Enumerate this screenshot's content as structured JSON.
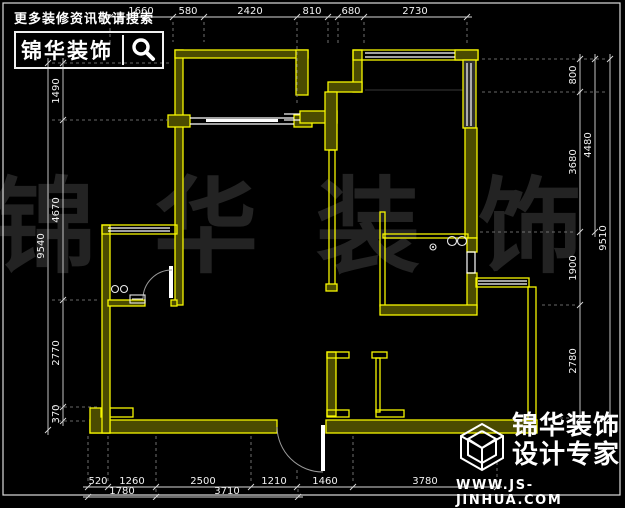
{
  "header": {
    "promo_text": "更多装修资讯敬请搜索",
    "brand": "锦华装饰"
  },
  "watermark": {
    "text": "锦华装饰"
  },
  "logo": {
    "brand": "锦华装饰",
    "tagline": "设计专家",
    "website": "WWW.JS-JINHUA.COM"
  },
  "colors": {
    "background": "#000000",
    "wall": "#f7f700",
    "wall_fill": "#4b4b00",
    "window": "#ffffff",
    "dimension_text": "#f2f2f2",
    "watermark": "#232323"
  },
  "dimension_chains": [
    {
      "id": "top-1",
      "orient": "h",
      "pos": 17,
      "ticks": [
        110,
        173,
        204,
        297,
        328
      ],
      "labels": [
        {
          "value": "1660",
          "at": 141
        },
        {
          "value": "580",
          "at": 188
        },
        {
          "value": "2420",
          "at": 250
        },
        {
          "value": "810",
          "at": 312
        }
      ]
    },
    {
      "id": "top-2",
      "orient": "h",
      "pos": 17,
      "ticks": [
        338,
        364,
        467
      ],
      "labels": [
        {
          "value": "680",
          "at": 351
        },
        {
          "value": "2730",
          "at": 415
        }
      ]
    },
    {
      "id": "left-outer",
      "orient": "v",
      "pos": 48,
      "ticks": [
        63,
        430
      ],
      "labels": [
        {
          "value": "9540",
          "at": 246
        }
      ]
    },
    {
      "id": "left-inner",
      "orient": "v",
      "pos": 63,
      "ticks": [
        63,
        120,
        300,
        407,
        421
      ],
      "labels": [
        {
          "value": "1490",
          "at": 91
        },
        {
          "value": "4670",
          "at": 210
        },
        {
          "value": "2770",
          "at": 353
        },
        {
          "value": "370",
          "at": 414
        }
      ]
    },
    {
      "id": "right-inner",
      "orient": "v",
      "pos": 580,
      "ticks": [
        59,
        92,
        232,
        305,
        418
      ],
      "labels": [
        {
          "value": "800",
          "at": 75
        },
        {
          "value": "3680",
          "at": 162
        },
        {
          "value": "1900",
          "at": 268
        },
        {
          "value": "2780",
          "at": 361
        }
      ]
    },
    {
      "id": "right-middle",
      "orient": "v",
      "pos": 595,
      "ticks": [
        59,
        232
      ],
      "labels": [
        {
          "value": "4480",
          "at": 145
        }
      ]
    },
    {
      "id": "right-outer",
      "orient": "v",
      "pos": 610,
      "ticks": [
        59,
        418
      ],
      "labels": [
        {
          "value": "9510",
          "at": 238
        }
      ]
    },
    {
      "id": "bottom-1",
      "orient": "h",
      "pos": 487,
      "ticks": [
        88,
        108,
        156,
        251,
        297,
        353,
        497
      ],
      "labels": [
        {
          "value": "520",
          "at": 98
        },
        {
          "value": "1260",
          "at": 132
        },
        {
          "value": "2500",
          "at": 203
        },
        {
          "value": "1210",
          "at": 274
        },
        {
          "value": "1460",
          "at": 325
        },
        {
          "value": "3780",
          "at": 425
        }
      ]
    },
    {
      "id": "bottom-2",
      "orient": "h",
      "pos": 497,
      "ticks": [
        88,
        156,
        298
      ],
      "labels": [
        {
          "value": "1780",
          "at": 122
        },
        {
          "value": "3710",
          "at": 227
        }
      ]
    }
  ]
}
